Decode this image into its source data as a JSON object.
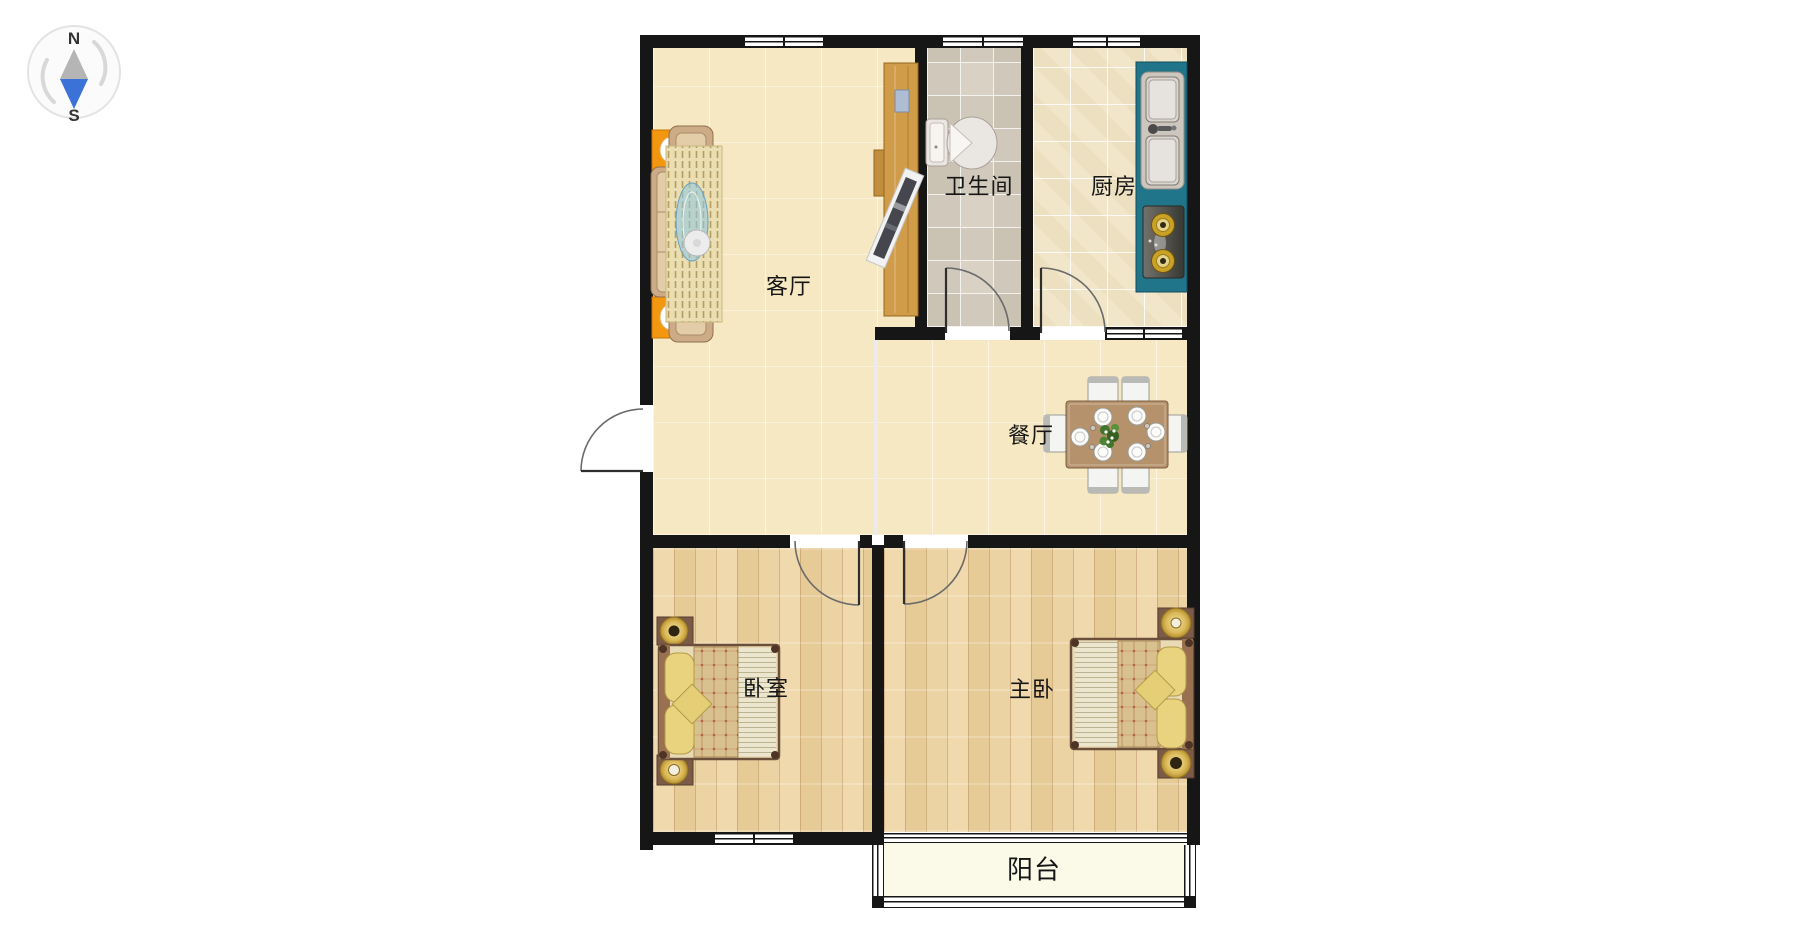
{
  "compass": {
    "north": "N",
    "south": "S"
  },
  "rooms": {
    "living": {
      "label": "客厅"
    },
    "bathroom": {
      "label": "卫生间"
    },
    "kitchen": {
      "label": "厨房"
    },
    "dining": {
      "label": "餐厅"
    },
    "bedroom": {
      "label": "卧室"
    },
    "master": {
      "label": "主卧"
    },
    "balcony": {
      "label": "阳台"
    }
  },
  "colors": {
    "wall": "#161616",
    "living_floor": "#f6e8c2",
    "bathroom_tile": "#d8d1c4",
    "kitchen_tile": "#f1e6c9",
    "wood_floor": "#ecd3a4",
    "balcony_floor": "#fbf9e7",
    "counter_teal": "#20758a",
    "accent_orange": "#f2970f",
    "compass_blue": "#3a72d8"
  }
}
